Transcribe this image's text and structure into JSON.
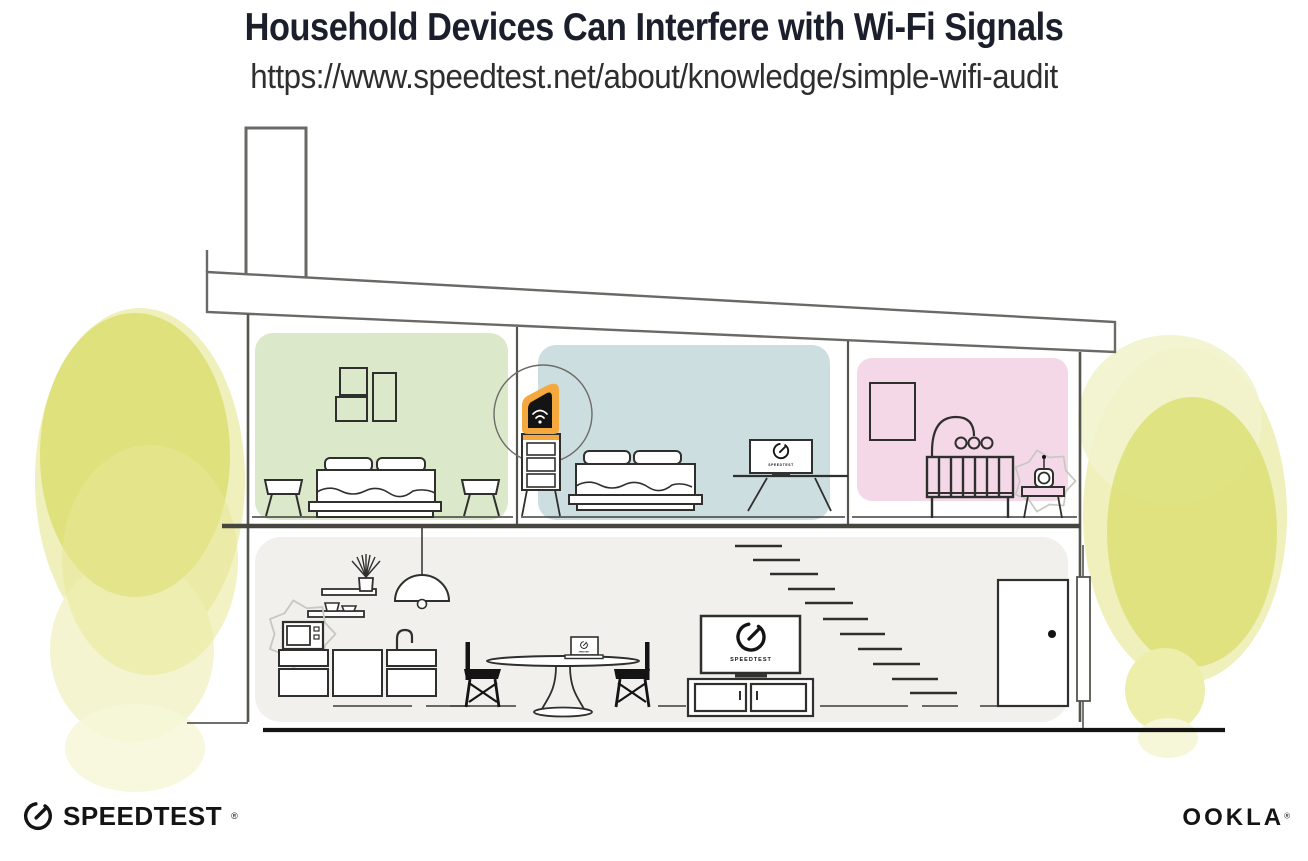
{
  "header": {
    "title": "Household Devices Can Interfere with Wi-Fi Signals",
    "url": "https://www.speedtest.net/about/knowledge/simple-wifi-audit"
  },
  "branding": {
    "speedtest_wordmark": "SPEEDTEST",
    "speedtest_reg_mark": "®",
    "ookla_wordmark": "OOKLA",
    "ookla_reg_mark": "®"
  },
  "illustration": {
    "screens": {
      "livingroom_tv_label": "SPEEDTEST",
      "bedroom_tv_label": "SPEEDTEST",
      "laptop_label": "SPEEDTEST"
    },
    "colors": {
      "room_green": "#dce8ca",
      "room_blue": "#cddee1",
      "room_pink": "#f4d8e7",
      "floor_gray": "#f1f0ed",
      "router_highlight_orange": "#f5a83d",
      "foliage_yellow": "#dddf75",
      "foliage_yellow_light": "#eff0bc",
      "foliage_yellow_pale": "#f6f7d8",
      "line_gray": "#55544e",
      "ink_black": "#141414"
    },
    "icons": [
      "speedtest-gauge-icon",
      "wifi-icon",
      "router-icon",
      "microwave-icon",
      "baby-monitor-icon",
      "interference-burst-icon",
      "pendant-lamp-icon",
      "plant-icon"
    ]
  }
}
